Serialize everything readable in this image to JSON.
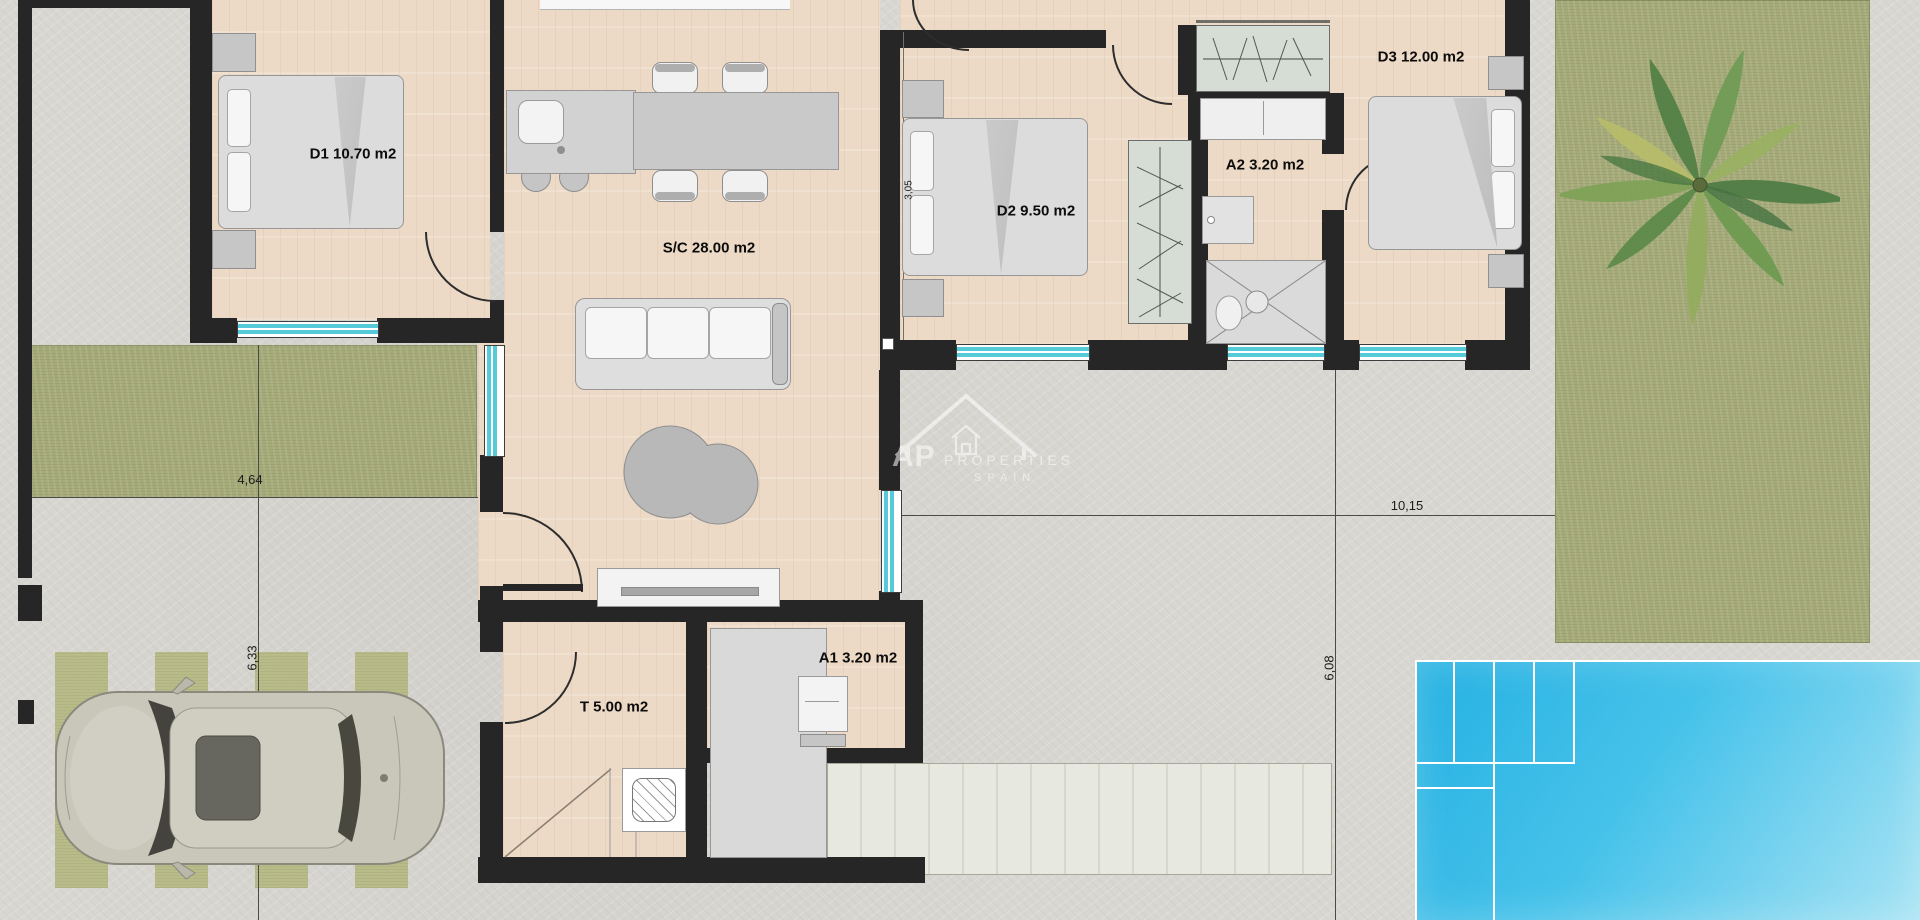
{
  "plan_title": "villa-floor-plan",
  "rooms": [
    {
      "id": "d1",
      "label": "D1 10.70 m2"
    },
    {
      "id": "sc",
      "label": "S/C 28.00 m2"
    },
    {
      "id": "d2",
      "label": "D2 9.50 m2"
    },
    {
      "id": "a2",
      "label": "A2 3.20 m2"
    },
    {
      "id": "d3",
      "label": "D3 12.00 m2"
    },
    {
      "id": "a1",
      "label": "A1 3.20 m2"
    },
    {
      "id": "t",
      "label": "T 5.00 m2"
    }
  ],
  "dimensions": [
    {
      "id": "plot-width-left",
      "label": "4,64"
    },
    {
      "id": "plot-width-right",
      "label": "10,15"
    },
    {
      "id": "plot-height-left",
      "label": "6,33"
    },
    {
      "id": "plot-height-right",
      "label": "6,08"
    },
    {
      "id": "d2-wall-height",
      "label": "3,05"
    }
  ],
  "watermark": {
    "initials": "AP",
    "name": "PROPERTIES",
    "country": "SPAIN"
  },
  "colors": {
    "wall": "#262626",
    "floor": "#eddac6",
    "glass": "#55cbda",
    "grass": "#a5aa79",
    "stripe": "#b6ba82",
    "concrete": "#d9d7d2",
    "pool-deep": "#25b1e2",
    "pool-light": "#a7e3f4",
    "furn": "#d9d9d9",
    "deck": "#e4e5dc"
  }
}
